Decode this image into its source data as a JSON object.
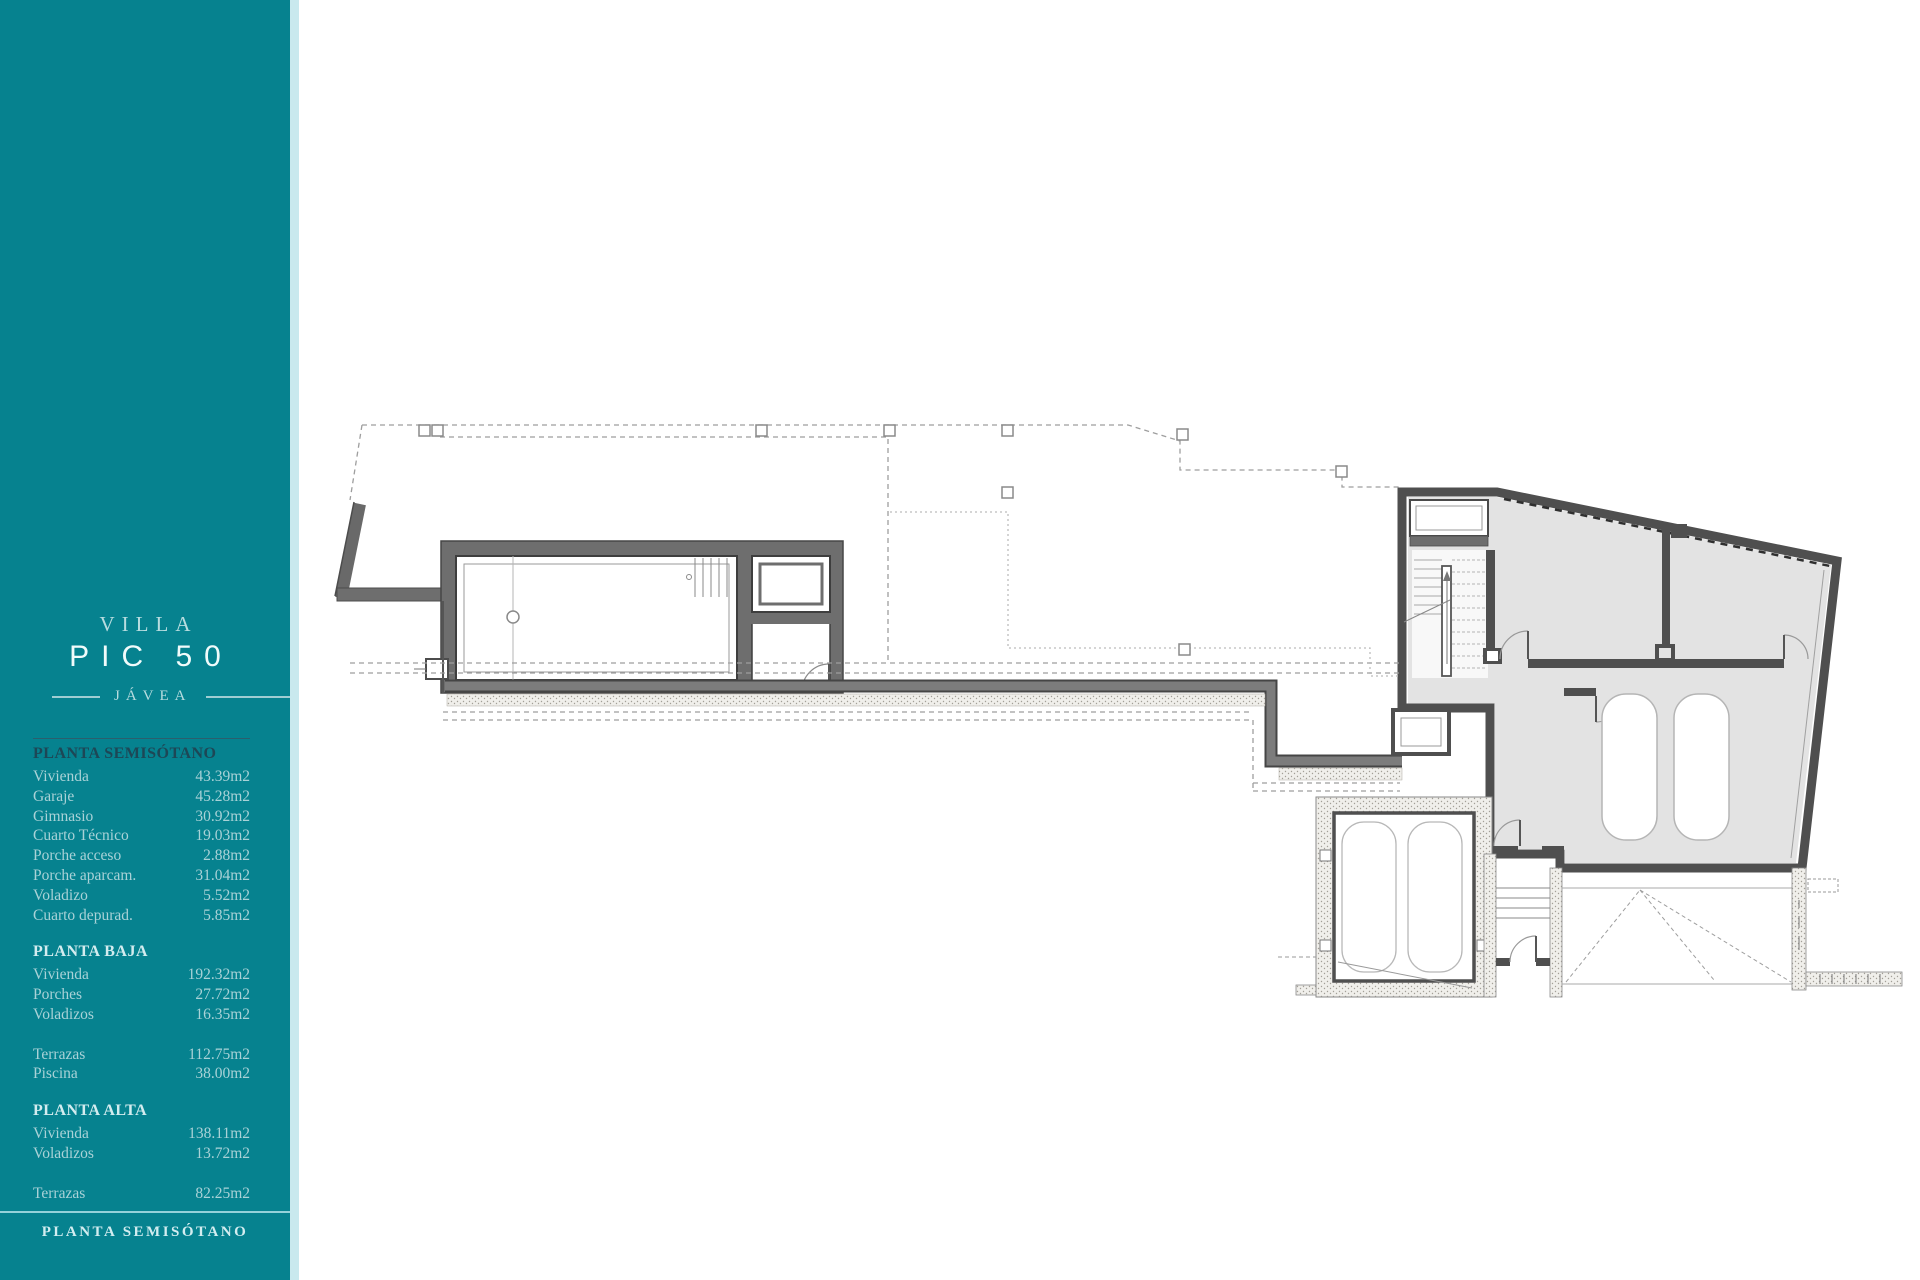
{
  "brand": {
    "villa_label": "VILLA",
    "model_label": "PIC 50",
    "location_label": "JÁVEA"
  },
  "colors": {
    "sidebar_teal": "#06828F",
    "sidebar_edge": "#C9E9EE",
    "text_light": "#A9D2D7",
    "text_bright": "#F0FBFB",
    "active_header_dark": "#1D4756",
    "wall_gray": "#7C7C7C",
    "wall_dark": "#4F4F4F",
    "room_fill": "#E3E3E3"
  },
  "sidebar": {
    "sections": [
      {
        "title": "PLANTA SEMISÓTANO",
        "rows": [
          {
            "label": "Vivienda",
            "value": "43.39m2"
          },
          {
            "label": "Garaje",
            "value": "45.28m2"
          },
          {
            "label": "Gimnasio",
            "value": "30.92m2"
          },
          {
            "label": "Cuarto Técnico",
            "value": "19.03m2"
          },
          {
            "label": "Porche acceso",
            "value": "2.88m2"
          },
          {
            "label": "Porche aparcam.",
            "value": "31.04m2"
          },
          {
            "label": "Voladizo",
            "value": "5.52m2"
          },
          {
            "label": "Cuarto depurad.",
            "value": "5.85m2"
          }
        ]
      },
      {
        "title": "PLANTA BAJA",
        "rows": [
          {
            "label": "Vivienda",
            "value": "192.32m2"
          },
          {
            "label": "Porches",
            "value": "27.72m2"
          },
          {
            "label": "Voladizos",
            "value": "16.35m2"
          },
          {
            "label": "Terrazas",
            "value": "112.75m2"
          },
          {
            "label": "Piscina",
            "value": "38.00m2"
          }
        ]
      },
      {
        "title": "PLANTA ALTA",
        "rows": [
          {
            "label": "Vivienda",
            "value": "138.11m2"
          },
          {
            "label": "Voladizos",
            "value": "13.72m2"
          },
          {
            "label": "Terrazas",
            "value": "82.25m2"
          }
        ]
      }
    ],
    "footer_label": "PLANTA SEMISÓTANO"
  }
}
